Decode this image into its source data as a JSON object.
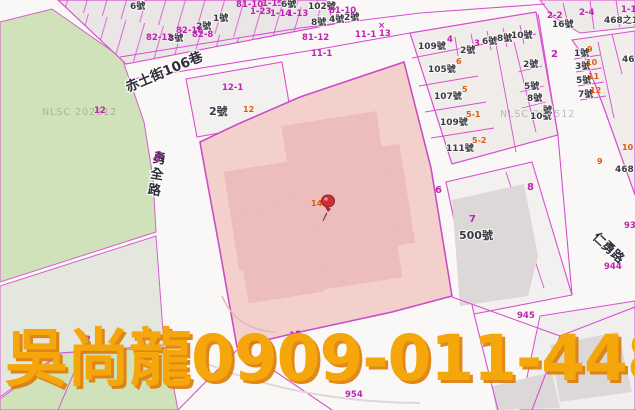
{
  "map": {
    "agent_overlay_text": "吳尚龍0909-011-448",
    "agent_overlay_color": "#f4a60a",
    "agent_overlay_shadow": "#dd7b04",
    "watermark_text": "NLSC 202512",
    "streets": {
      "lane106": "赤土街106巷",
      "yongquan": "勇全路",
      "renyong": "仁勇路"
    },
    "pin": {
      "name": "red-pushpin",
      "x": 320,
      "y": 192
    },
    "colors": {
      "parcel_line": "#d84fd0",
      "parcel_fill": "#eae6e6",
      "green_area": "#d0e2ba",
      "greengrey_area": "#e4e7de",
      "selected_parcel": "#f4d0cd",
      "selected_building": "#edbcbc",
      "building_grey": "#dcd8d8",
      "road_white": "#faf8f6",
      "house_label": "#3a3a42",
      "lot_label": "#bf24b0",
      "annex_label": "#dd5c14"
    },
    "labels": [
      {
        "t": "6號",
        "x": 130,
        "y": 9,
        "c": "h"
      },
      {
        "t": "81-10",
        "x": 236,
        "y": 7,
        "c": "m"
      },
      {
        "t": "1-15",
        "x": 262,
        "y": 6,
        "c": "m"
      },
      {
        "t": "1-23",
        "x": 250,
        "y": 14,
        "c": "m"
      },
      {
        "t": "6號",
        "x": 281,
        "y": 7,
        "c": "h"
      },
      {
        "t": "102號",
        "x": 308,
        "y": 9,
        "c": "h"
      },
      {
        "t": "1-14",
        "x": 270,
        "y": 16,
        "c": "m"
      },
      {
        "t": "1-13",
        "x": 287,
        "y": 16,
        "c": "m"
      },
      {
        "t": "1號",
        "x": 213,
        "y": 21,
        "c": "h"
      },
      {
        "t": "2號",
        "x": 196,
        "y": 29,
        "c": "h"
      },
      {
        "t": "82-8",
        "x": 192,
        "y": 37,
        "c": "m"
      },
      {
        "t": "8號",
        "x": 168,
        "y": 41,
        "c": "h"
      },
      {
        "t": "82-12",
        "x": 146,
        "y": 40,
        "c": "m"
      },
      {
        "t": "82-16",
        "x": 176,
        "y": 33,
        "c": "m"
      },
      {
        "t": "8號",
        "x": 311,
        "y": 25,
        "c": "h"
      },
      {
        "t": "4號",
        "x": 329,
        "y": 22,
        "c": "h"
      },
      {
        "t": "2號",
        "x": 344,
        "y": 20,
        "c": "h"
      },
      {
        "t": "81-10",
        "x": 329,
        "y": 13,
        "c": "m"
      },
      {
        "t": "81-12",
        "x": 302,
        "y": 40,
        "c": "m"
      },
      {
        "t": "11-1",
        "x": 355,
        "y": 37,
        "c": "m"
      },
      {
        "t": "×",
        "x": 378,
        "y": 28,
        "c": "m"
      },
      {
        "t": "13",
        "x": 379,
        "y": 36,
        "c": "m"
      },
      {
        "t": "11-1",
        "x": 311,
        "y": 56,
        "c": "m"
      },
      {
        "t": "12-1",
        "x": 222,
        "y": 90,
        "c": "m"
      },
      {
        "t": "2號",
        "x": 209,
        "y": 115,
        "c": "h2"
      },
      {
        "t": "12",
        "x": 243,
        "y": 112,
        "c": "o",
        "s": 10
      },
      {
        "t": "12",
        "x": 94,
        "y": 113,
        "c": "m"
      },
      {
        "t": "20",
        "x": 158,
        "y": 163,
        "c": "m",
        "r": -62
      },
      {
        "t": "109號",
        "x": 418,
        "y": 49,
        "c": "h"
      },
      {
        "t": "4",
        "x": 447,
        "y": 42,
        "c": "m"
      },
      {
        "t": "2號",
        "x": 460,
        "y": 53,
        "c": "h"
      },
      {
        "t": "3",
        "x": 474,
        "y": 46,
        "c": "m"
      },
      {
        "t": "6號",
        "x": 482,
        "y": 44,
        "c": "h"
      },
      {
        "t": "8號",
        "x": 497,
        "y": 41,
        "c": "h"
      },
      {
        "t": "10號",
        "x": 511,
        "y": 38,
        "c": "h"
      },
      {
        "t": "16號",
        "x": 552,
        "y": 27,
        "c": "h"
      },
      {
        "t": "2-2",
        "x": 547,
        "y": 18,
        "c": "m"
      },
      {
        "t": "2-4",
        "x": 579,
        "y": 15,
        "c": "m"
      },
      {
        "t": "468之1",
        "x": 604,
        "y": 23,
        "c": "h"
      },
      {
        "t": "1-1",
        "x": 621,
        "y": 12,
        "c": "m"
      },
      {
        "t": "105號",
        "x": 428,
        "y": 72,
        "c": "h"
      },
      {
        "t": "6",
        "x": 456,
        "y": 64,
        "c": "o"
      },
      {
        "t": "107號",
        "x": 434,
        "y": 99,
        "c": "h"
      },
      {
        "t": "5",
        "x": 462,
        "y": 92,
        "c": "o"
      },
      {
        "t": "109號",
        "x": 440,
        "y": 125,
        "c": "h"
      },
      {
        "t": "5-1",
        "x": 466,
        "y": 117,
        "c": "o"
      },
      {
        "t": "111號",
        "x": 446,
        "y": 151,
        "c": "h"
      },
      {
        "t": "5-2",
        "x": 472,
        "y": 143,
        "c": "o"
      },
      {
        "t": "2號",
        "x": 523,
        "y": 67,
        "c": "h"
      },
      {
        "t": "5號",
        "x": 524,
        "y": 89,
        "c": "h"
      },
      {
        "t": "8號",
        "x": 527,
        "y": 101,
        "c": "h"
      },
      {
        "t": "10號",
        "x": 530,
        "y": 119,
        "c": "h"
      },
      {
        "t": "2",
        "x": 551,
        "y": 57,
        "c": "m2"
      },
      {
        "t": "1號",
        "x": 574,
        "y": 56,
        "c": "h"
      },
      {
        "t": "9",
        "x": 587,
        "y": 52,
        "c": "o"
      },
      {
        "t": "3號",
        "x": 575,
        "y": 69,
        "c": "h"
      },
      {
        "t": "10",
        "x": 586,
        "y": 65,
        "c": "o"
      },
      {
        "t": "5號",
        "x": 576,
        "y": 83,
        "c": "h"
      },
      {
        "t": "11",
        "x": 588,
        "y": 79,
        "c": "o"
      },
      {
        "t": "7號",
        "x": 578,
        "y": 97,
        "c": "h"
      },
      {
        "t": "12",
        "x": 590,
        "y": 93,
        "c": "o"
      },
      {
        "t": "號",
        "x": 543,
        "y": 113,
        "c": "h"
      },
      {
        "t": "46",
        "x": 622,
        "y": 62,
        "c": "h"
      },
      {
        "t": "10",
        "x": 622,
        "y": 150,
        "c": "o"
      },
      {
        "t": "9",
        "x": 597,
        "y": 164,
        "c": "o"
      },
      {
        "t": "468",
        "x": 615,
        "y": 172,
        "c": "h"
      },
      {
        "t": "6",
        "x": 435,
        "y": 193,
        "c": "m2"
      },
      {
        "t": "7",
        "x": 469,
        "y": 222,
        "c": "m2"
      },
      {
        "t": "500號",
        "x": 459,
        "y": 239,
        "c": "h2"
      },
      {
        "t": "8",
        "x": 527,
        "y": 190,
        "c": "m2"
      },
      {
        "t": "93",
        "x": 624,
        "y": 228,
        "c": "m"
      },
      {
        "t": "944",
        "x": 604,
        "y": 269,
        "c": "m"
      },
      {
        "t": "945",
        "x": 517,
        "y": 318,
        "c": "m"
      },
      {
        "t": "954",
        "x": 345,
        "y": 397,
        "c": "m"
      },
      {
        "t": "15",
        "x": 290,
        "y": 338,
        "c": "m",
        "r": -8
      },
      {
        "t": "2",
        "x": 85,
        "y": 342,
        "c": "m"
      },
      {
        "t": "14",
        "x": 311,
        "y": 206,
        "c": "o"
      }
    ]
  }
}
